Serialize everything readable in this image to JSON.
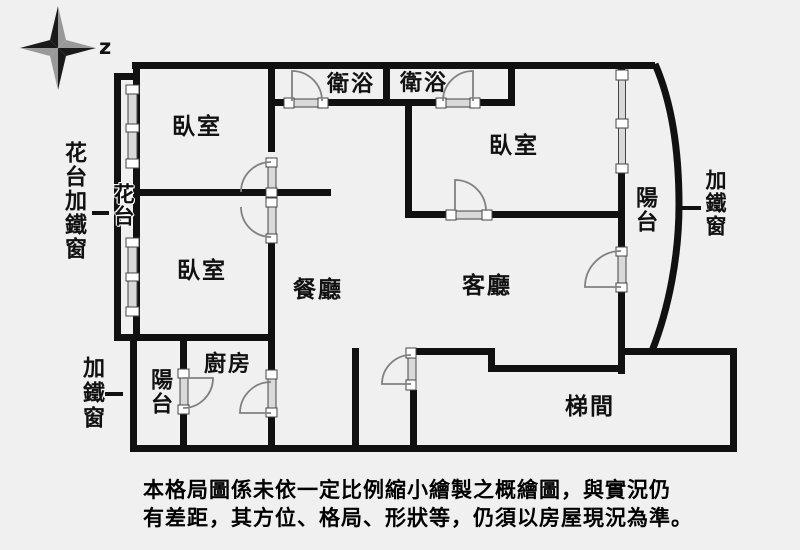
{
  "compass": {
    "label": "z"
  },
  "rooms": {
    "bedroom_top_left": "臥室",
    "bedroom_bottom_left": "臥室",
    "bedroom_right": "臥室",
    "bathroom_1": "衛浴",
    "bathroom_2": "衛浴",
    "dining_room": "餐廳",
    "living_room": "客廳",
    "kitchen": "廚房",
    "stairwell": "梯間",
    "balcony_bottom_left": "陽台",
    "balcony_right": "陽台",
    "flower_bed_strip": "花台"
  },
  "annotations": {
    "left_note": "花台加鐵窗",
    "bottom_left_note": "加鐵窗",
    "right_note": "加鐵窗"
  },
  "disclaimer": {
    "line_1": "本格局圖係未依一定比例縮小繪製之概繪圖，與實況仍",
    "line_2": "有差距，其方位、格局、形狀等，仍須以房屋現況為準。"
  },
  "colors": {
    "wall": "#111111",
    "background": "#f0f0f0",
    "window_fill": "#d9d9d9",
    "arc_stroke": "#808080",
    "compass_dark": "#1a1a1a",
    "compass_light": "#999999"
  }
}
